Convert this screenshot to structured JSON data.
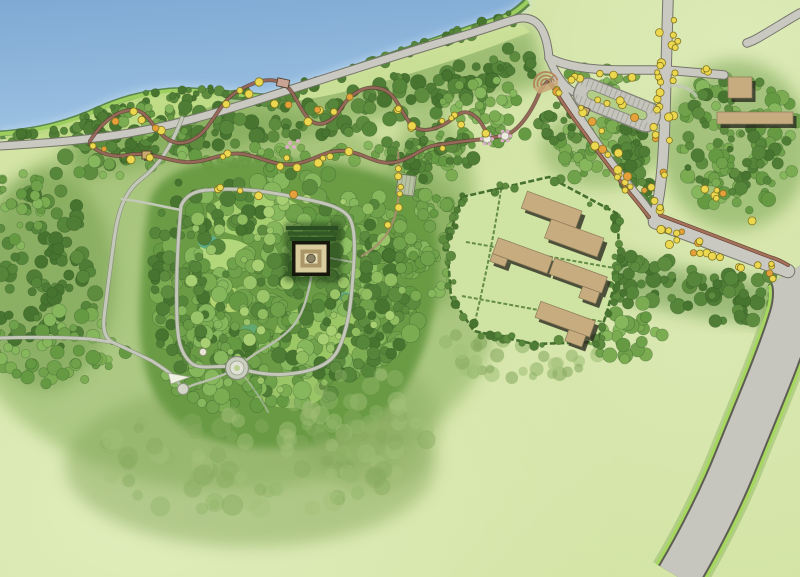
{
  "map": {
    "title": "Illustrated park master plan",
    "description": "Hand-rendered aerial site plan of a riverside mound park with winding trails, a stepped temple mound inside a square earthwork, a parking loop, a hedged visitor compound and a highway corridor",
    "features": [
      {
        "id": "river",
        "label": "River"
      },
      {
        "id": "shoreline-road",
        "label": "Shoreline road"
      },
      {
        "id": "riverside-hill",
        "label": "Riverside meadow hill"
      },
      {
        "id": "winding-trail",
        "label": "Winding interpretive trail loop"
      },
      {
        "id": "trail-shelter",
        "label": "Trail shelter"
      },
      {
        "id": "trail-pavilions",
        "label": "Blossom trail pavilions"
      },
      {
        "id": "trailhead-amphitheater",
        "label": "Trailhead amphitheater"
      },
      {
        "id": "parking-loop",
        "label": "Parking loop with stalls"
      },
      {
        "id": "parking-kiosk",
        "label": "Parking kiosk"
      },
      {
        "id": "entry-road",
        "label": "Tree-lined entry road"
      },
      {
        "id": "entry-crossroads",
        "label": "Entry crossroads"
      },
      {
        "id": "service-buildings",
        "label": "Service buildings"
      },
      {
        "id": "visitor-compound",
        "label": "Hedged visitor compound"
      },
      {
        "id": "earthwork-enclosure",
        "label": "Square earthwork enclosure loop path"
      },
      {
        "id": "temple-mound",
        "label": "Stepped temple mound with summit circle"
      },
      {
        "id": "terraces",
        "label": "Mound terraces"
      },
      {
        "id": "circular-plaza",
        "label": "Circular plaza"
      },
      {
        "id": "small-circle-plaza",
        "label": "Small circular plaza"
      },
      {
        "id": "small-dome",
        "label": "Small domed mound"
      },
      {
        "id": "garden-grid",
        "label": "Gridded garden plot"
      },
      {
        "id": "highway",
        "label": "Highway corridor"
      },
      {
        "id": "meadow",
        "label": "Open meadow"
      },
      {
        "id": "forest",
        "label": "Forest canopy"
      }
    ],
    "counts": {
      "compound_buildings": 4,
      "service_buildings": 2,
      "trail_pavilions": 2
    }
  },
  "palette": {
    "water_deep": "#7fa9d4",
    "water": "#9dc2e2",
    "water_edge": "#bcd8ee",
    "meadow": "#d3e4a5",
    "meadow_light": "#e0edbd",
    "hill": "#c0dc86",
    "shore_strip": "#9ccf5e",
    "treeline": "#4d7a35",
    "forest_wash": "#6f9e48",
    "road": "#c9c9c1",
    "road_edge": "#75756b",
    "path": "#c3c8b8",
    "highway": "#c6c6bf",
    "verge": "#a6d75f",
    "trail": "#96685a",
    "trail_dark": "#5f4034",
    "flowering_tree": "#ecd84e",
    "flowering_tree_orange": "#e5a03c",
    "blossom_pink": "#dfaecb",
    "building": "#c7ac80",
    "building_shadow": "#2c2c21",
    "hedge": "#45702f",
    "compound_lawn": "#cfe3a3",
    "mound_dark": "#17170e",
    "mound_cream": "#d9cc9d",
    "mound_tan": "#a99565",
    "mound_inner": "#e4dbb2",
    "mound_circle": "#8b8266",
    "plaza": "#c9cdbd",
    "foliage_dark": [
      "#4f7d35",
      "#55863a",
      "#47742f",
      "#5d8c3f"
    ],
    "foliage_mid": [
      "#6fa24a",
      "#7bac52",
      "#659a43",
      "#86b75c"
    ],
    "foliage_light": [
      "#9ac468",
      "#a8d072",
      "#8fbd60"
    ],
    "foliage_soft": [
      "#93b56b",
      "#a3c17a",
      "#88aa60"
    ]
  }
}
